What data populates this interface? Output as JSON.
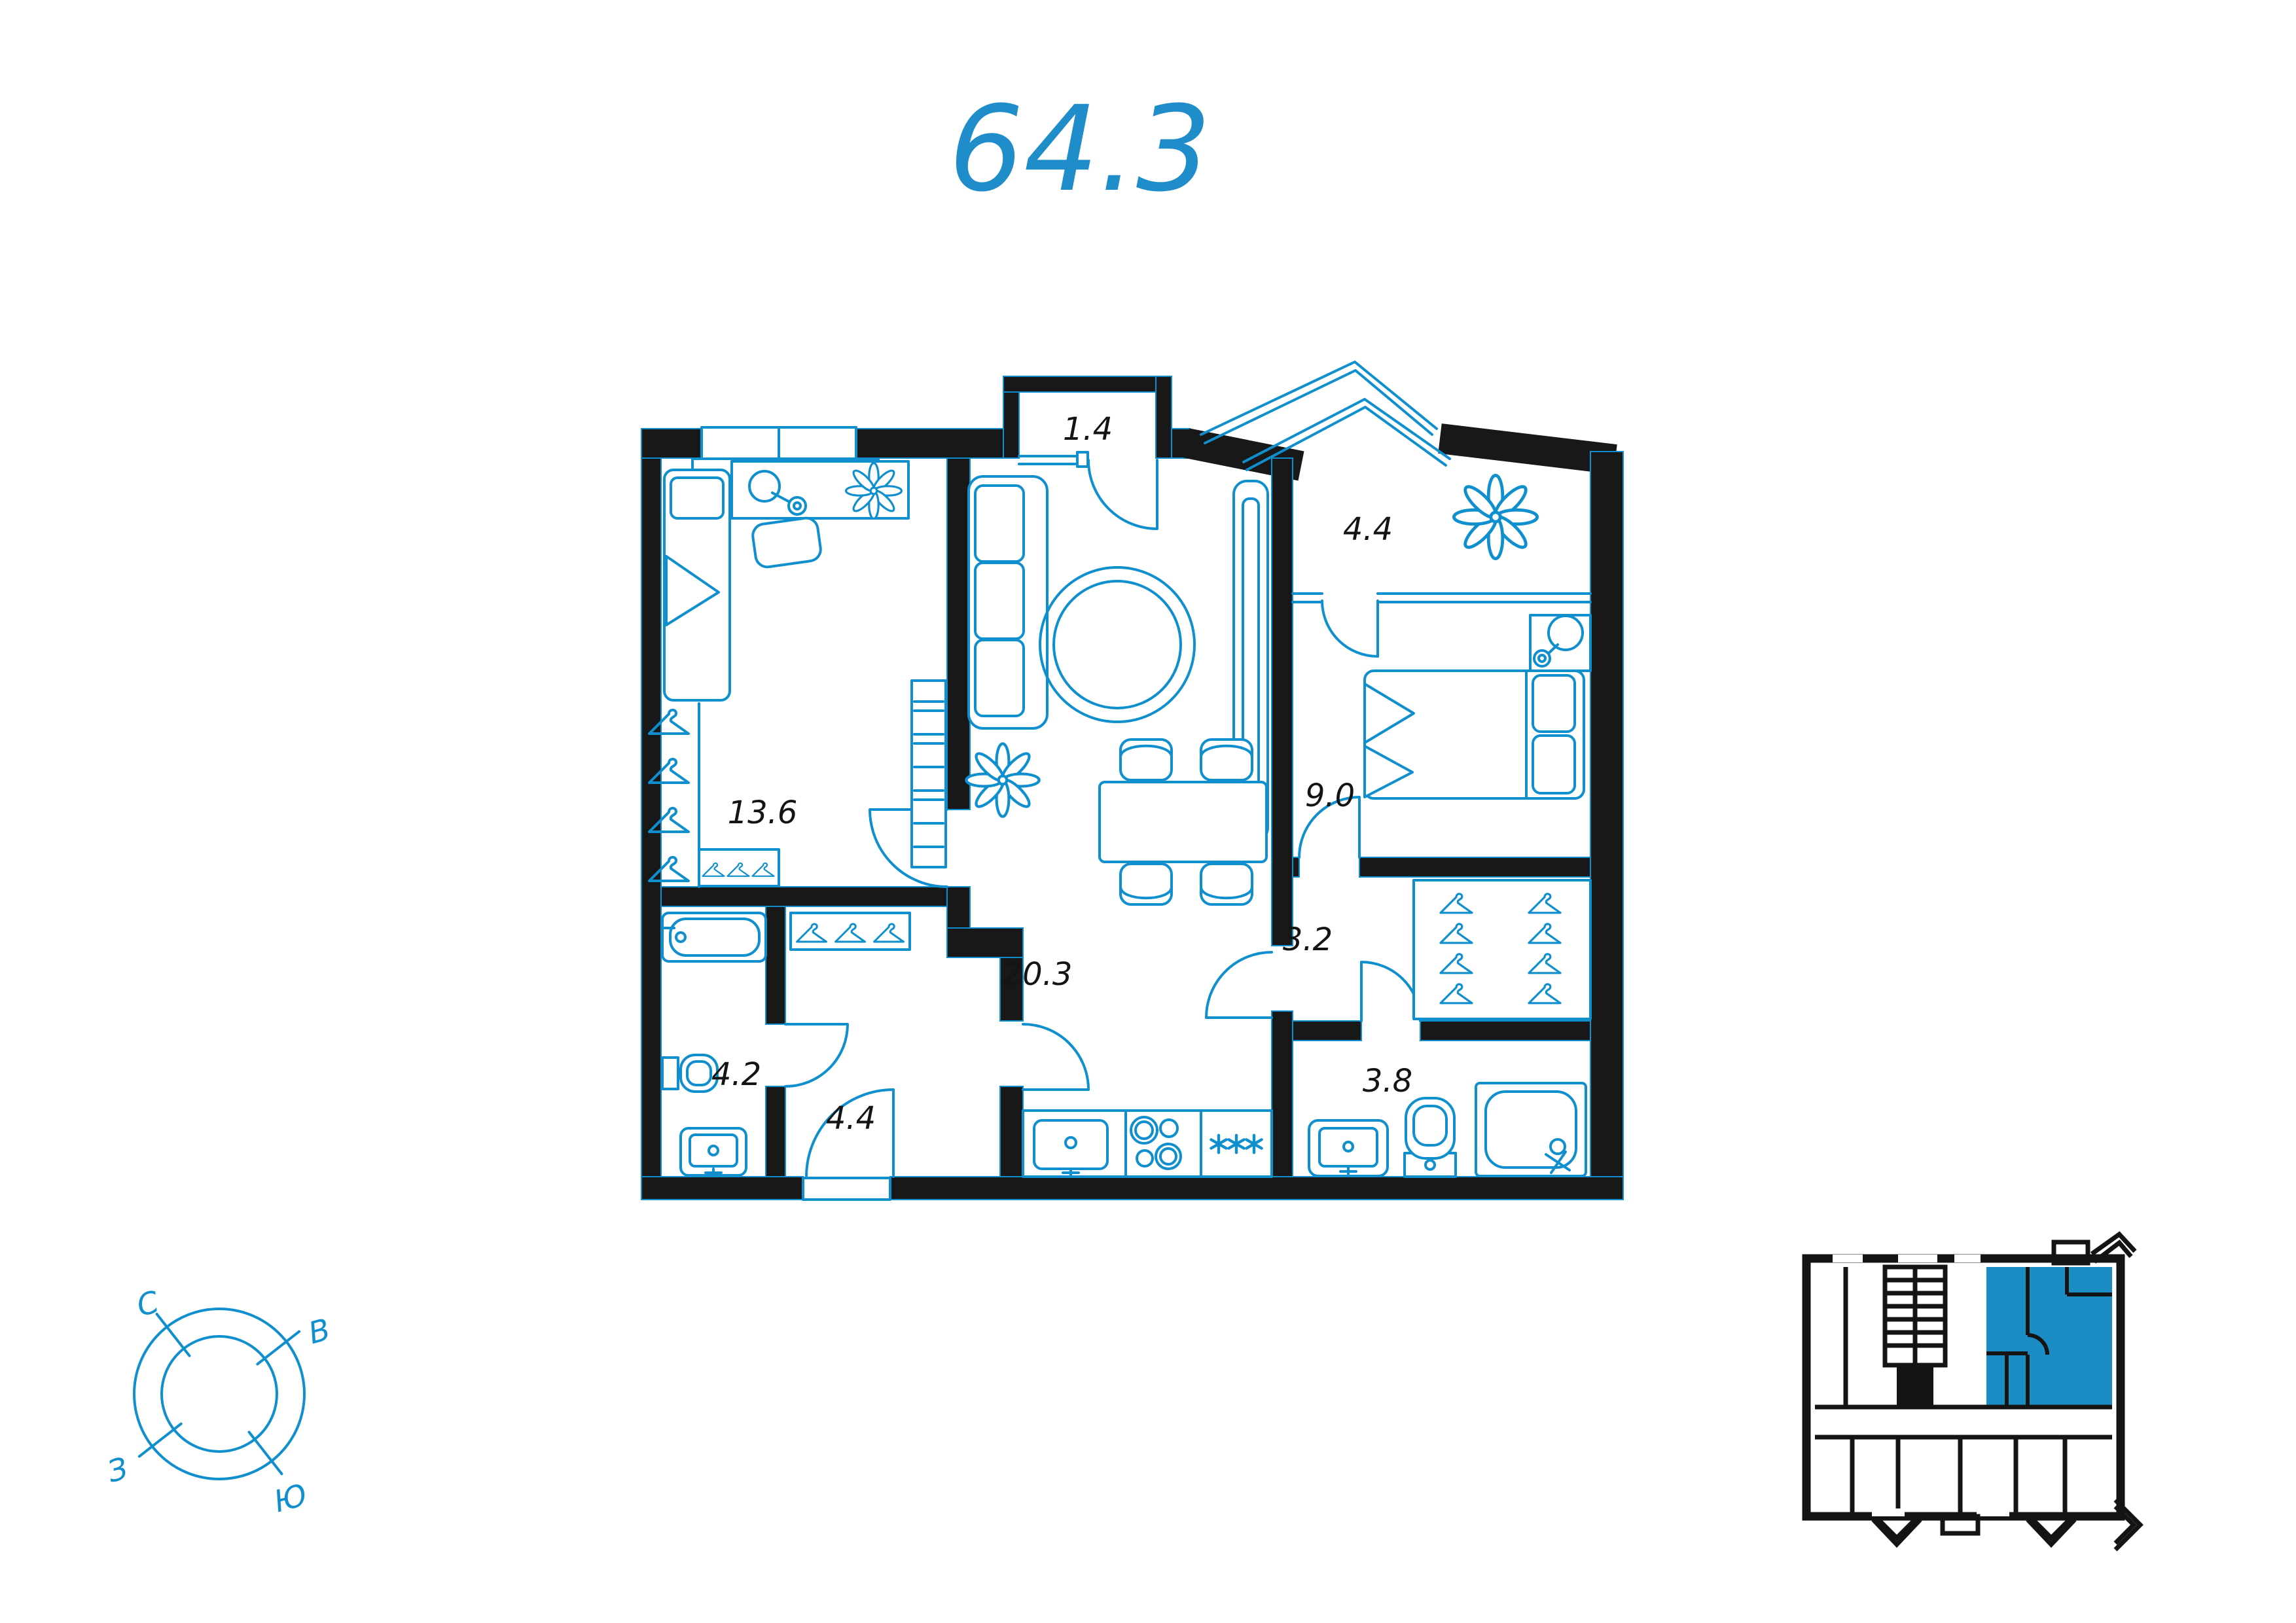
{
  "title": "64.3",
  "colors": {
    "accent": "#1f8dc9",
    "line": "#0f8fce",
    "wall": "#181818",
    "highlight": "#1b8dc4"
  },
  "plan": {
    "rooms": [
      {
        "id": "vestibule",
        "area": "1.4"
      },
      {
        "id": "loggia",
        "area": "4.4"
      },
      {
        "id": "bedroom",
        "area": "13.6"
      },
      {
        "id": "bedroom-2",
        "area": "9.0"
      },
      {
        "id": "hall",
        "area": "3.2"
      },
      {
        "id": "living-kitchen",
        "area": "20.3"
      },
      {
        "id": "bathroom",
        "area": "4.2"
      },
      {
        "id": "hallway",
        "area": "4.4"
      },
      {
        "id": "wc",
        "area": "3.8"
      }
    ]
  },
  "compass": {
    "north": "С",
    "east": "В",
    "south": "Ю",
    "west": "З"
  }
}
